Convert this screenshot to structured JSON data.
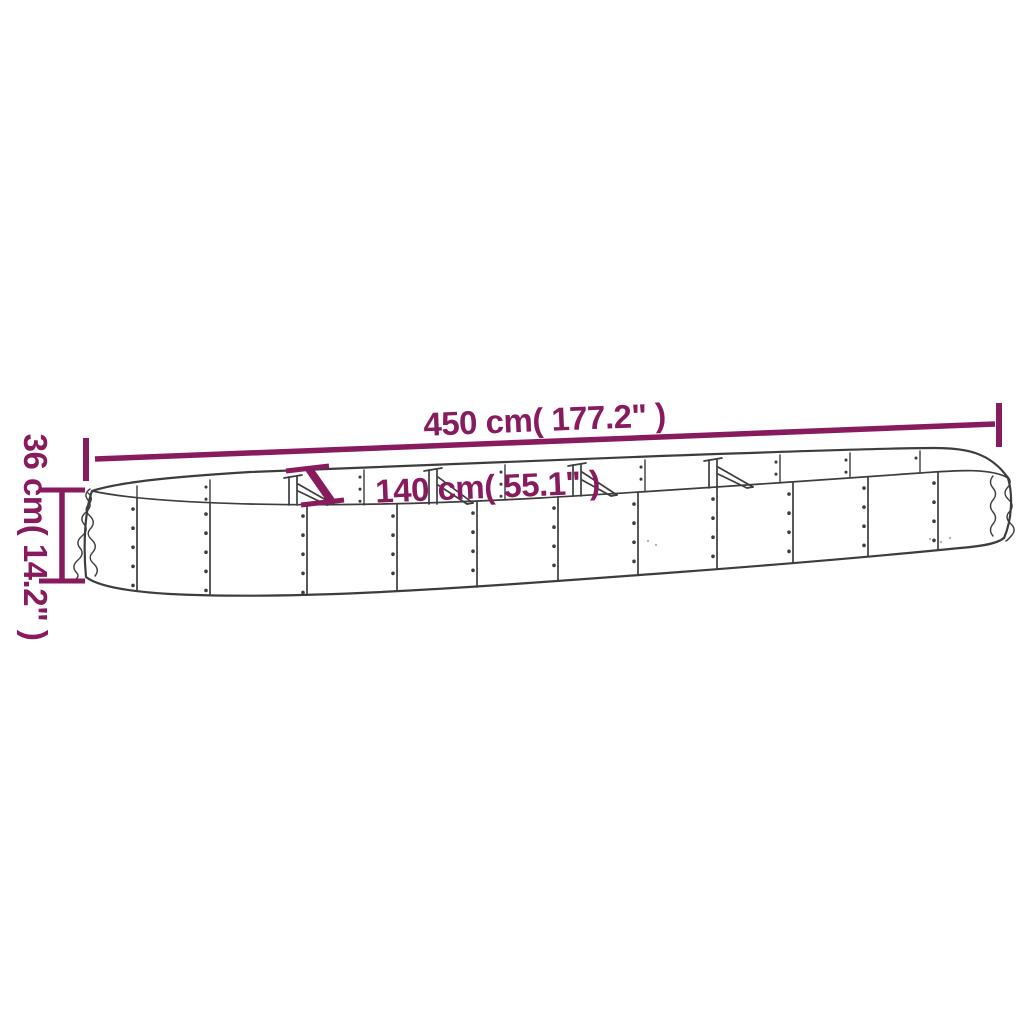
{
  "diagram": {
    "type": "product-dimension-drawing",
    "subject": "oval-raised-garden-bed",
    "background_color": "#ffffff",
    "line_color": "#3d3d3d",
    "dimension_color": "#871b5e",
    "dimensions": {
      "length": "450 cm( 177.2\" )",
      "width": "140 cm( 55.1\" )",
      "height": "36 cm( 14.2\" )"
    }
  }
}
